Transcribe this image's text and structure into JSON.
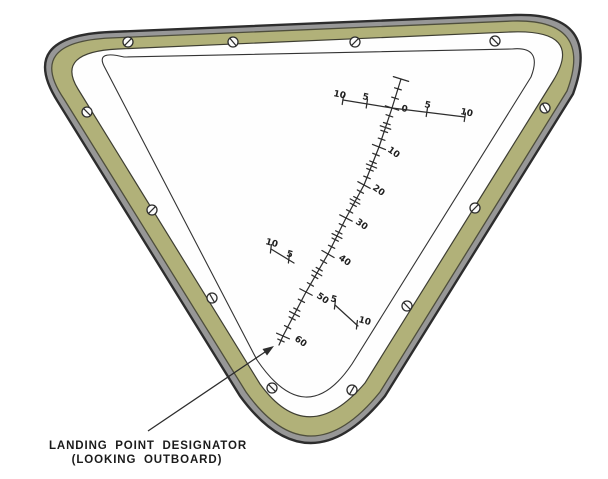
{
  "caption": {
    "line1": "LANDING POINT DESIGNATOR",
    "line2": "(LOOKING OUTBOARD)"
  },
  "colors": {
    "rim": "#979797",
    "gasket": "#b1b179",
    "ink": "#2d2d2d",
    "pane": "#fefefe"
  },
  "scale": {
    "elevation": {
      "cap": [
        401,
        79
      ],
      "end": [
        279,
        345
      ],
      "pre_zero_fracs": [
        0.34,
        0.66
      ],
      "majors": [
        {
          "label": "0",
          "pt": [
            392,
            108
          ],
          "lx": 401,
          "ly": 111,
          "rot": 10
        },
        {
          "label": "10",
          "pt": [
            379,
            147
          ],
          "lx": 387,
          "ly": 151,
          "rot": 35
        },
        {
          "label": "20",
          "pt": [
            364,
            185
          ],
          "lx": 372,
          "ly": 189,
          "rot": 35
        },
        {
          "label": "30",
          "pt": [
            346,
            218
          ],
          "lx": 355,
          "ly": 223,
          "rot": 35
        },
        {
          "label": "40",
          "pt": [
            328,
            254
          ],
          "lx": 338,
          "ly": 259,
          "rot": 35
        },
        {
          "label": "50",
          "pt": [
            306,
            292
          ],
          "lx": 316,
          "ly": 297,
          "rot": 35
        },
        {
          "label": "60",
          "pt": [
            283,
            336
          ],
          "lx": 294,
          "ly": 340,
          "rot": 35
        }
      ],
      "minor_fracs": [
        0.2,
        0.4,
        0.6,
        0.8
      ],
      "tick_len": {
        "minor": 7,
        "mid": 11,
        "major": 14
      }
    },
    "azimuth": {
      "polyline": [
        [
          343,
          100
        ],
        [
          392,
          108
        ],
        [
          465,
          117
        ]
      ],
      "ticks": [
        [
          343,
          100
        ],
        [
          367,
          103.5
        ],
        [
          427,
          112
        ],
        [
          465,
          117
        ]
      ],
      "labels": [
        {
          "text": "10",
          "x": 333,
          "y": 96,
          "rot": 12
        },
        {
          "text": "5",
          "x": 362,
          "y": 99,
          "rot": 12
        },
        {
          "text": "5",
          "x": 424,
          "y": 107,
          "rot": 12
        },
        {
          "text": "10",
          "x": 460,
          "y": 114,
          "rot": 12
        }
      ]
    },
    "laterals": [
      {
        "line": [
          [
            271,
            249
          ],
          [
            294,
            263
          ]
        ],
        "ticks": [
          [
            271,
            249
          ],
          [
            289,
            259
          ]
        ],
        "labels": [
          {
            "text": "10",
            "x": 265,
            "y": 244,
            "rot": 15
          },
          {
            "text": "5",
            "x": 286,
            "y": 256,
            "rot": 15
          }
        ]
      },
      {
        "line": [
          [
            335,
            305
          ],
          [
            358,
            326
          ]
        ],
        "ticks": [
          [
            335,
            305
          ],
          [
            357,
            325
          ]
        ],
        "labels": [
          {
            "text": "5",
            "x": 330,
            "y": 301,
            "rot": 15
          },
          {
            "text": "10",
            "x": 358,
            "y": 322,
            "rot": 15
          }
        ]
      }
    ]
  },
  "screws": [
    {
      "x": 128,
      "y": 42,
      "a": 135
    },
    {
      "x": 233,
      "y": 42,
      "a": 50
    },
    {
      "x": 355,
      "y": 42,
      "a": 135
    },
    {
      "x": 495,
      "y": 41,
      "a": 45
    },
    {
      "x": 545,
      "y": 108,
      "a": 60
    },
    {
      "x": 475,
      "y": 208,
      "a": 135
    },
    {
      "x": 407,
      "y": 306,
      "a": 45
    },
    {
      "x": 352,
      "y": 390,
      "a": 120
    },
    {
      "x": 87,
      "y": 112,
      "a": 45
    },
    {
      "x": 152,
      "y": 210,
      "a": 135
    },
    {
      "x": 212,
      "y": 298,
      "a": 60
    },
    {
      "x": 272,
      "y": 388,
      "a": 45
    }
  ]
}
